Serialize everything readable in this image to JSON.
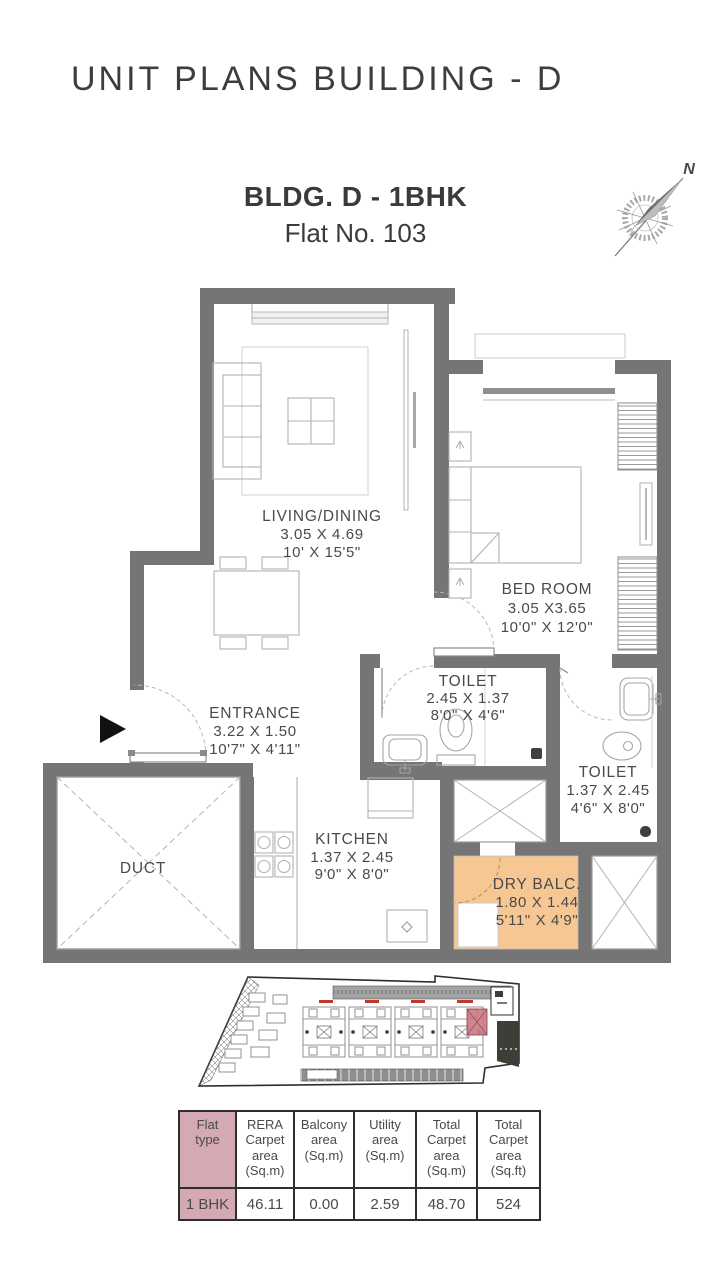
{
  "header": {
    "title": "UNIT PLANS BUILDING - D"
  },
  "unit": {
    "building_label": "BLDG. D - 1BHK",
    "flat_label": "Flat No. 103"
  },
  "compass": {
    "north_label": "N"
  },
  "floor_plan": {
    "living": {
      "name": "LIVING/DINING",
      "dim_m": "3.05 X 4.69",
      "dim_ft": "10' X 15'5\""
    },
    "bedroom": {
      "name": "BED ROOM",
      "dim_m": "3.05 X3.65",
      "dim_ft": "10'0\" X 12'0\""
    },
    "entrance": {
      "name": "ENTRANCE",
      "dim_m": "3.22 X 1.50",
      "dim_ft": "10'7\" X 4'11\""
    },
    "toilet1": {
      "name": "TOILET",
      "dim_m": "2.45 X 1.37",
      "dim_ft": "8'0\" X 4'6\""
    },
    "toilet2": {
      "name": "TOILET",
      "dim_m": "1.37 X 2.45",
      "dim_ft": "4'6\" X 8'0\""
    },
    "kitchen": {
      "name": "KITCHEN",
      "dim_m": "1.37 X 2.45",
      "dim_ft": "9'0\" X 8'0\""
    },
    "duct": {
      "name": "DUCT"
    },
    "dry_balcony": {
      "name": "DRY BALC.",
      "dim_m": "1.80 X 1.44",
      "dim_ft": "5'11\" X 4'9\""
    }
  },
  "colors": {
    "wall": "#757575",
    "dry_balcony_fill": "#f6c793",
    "table_highlight": "#d5a9b4",
    "keyplan_highlight": "#c97983"
  },
  "area_table": {
    "headers": [
      "Flat\ntype",
      "RERA\nCarpet\narea\n(Sq.m)",
      "Balcony\narea\n(Sq.m)",
      "Utility\narea\n(Sq.m)",
      "Total\nCarpet\narea\n(Sq.m)",
      "Total\nCarpet\narea\n(Sq.ft)"
    ],
    "rows": [
      [
        "1 BHK",
        "46.11",
        "0.00",
        "2.59",
        "48.70",
        "524"
      ]
    ]
  }
}
